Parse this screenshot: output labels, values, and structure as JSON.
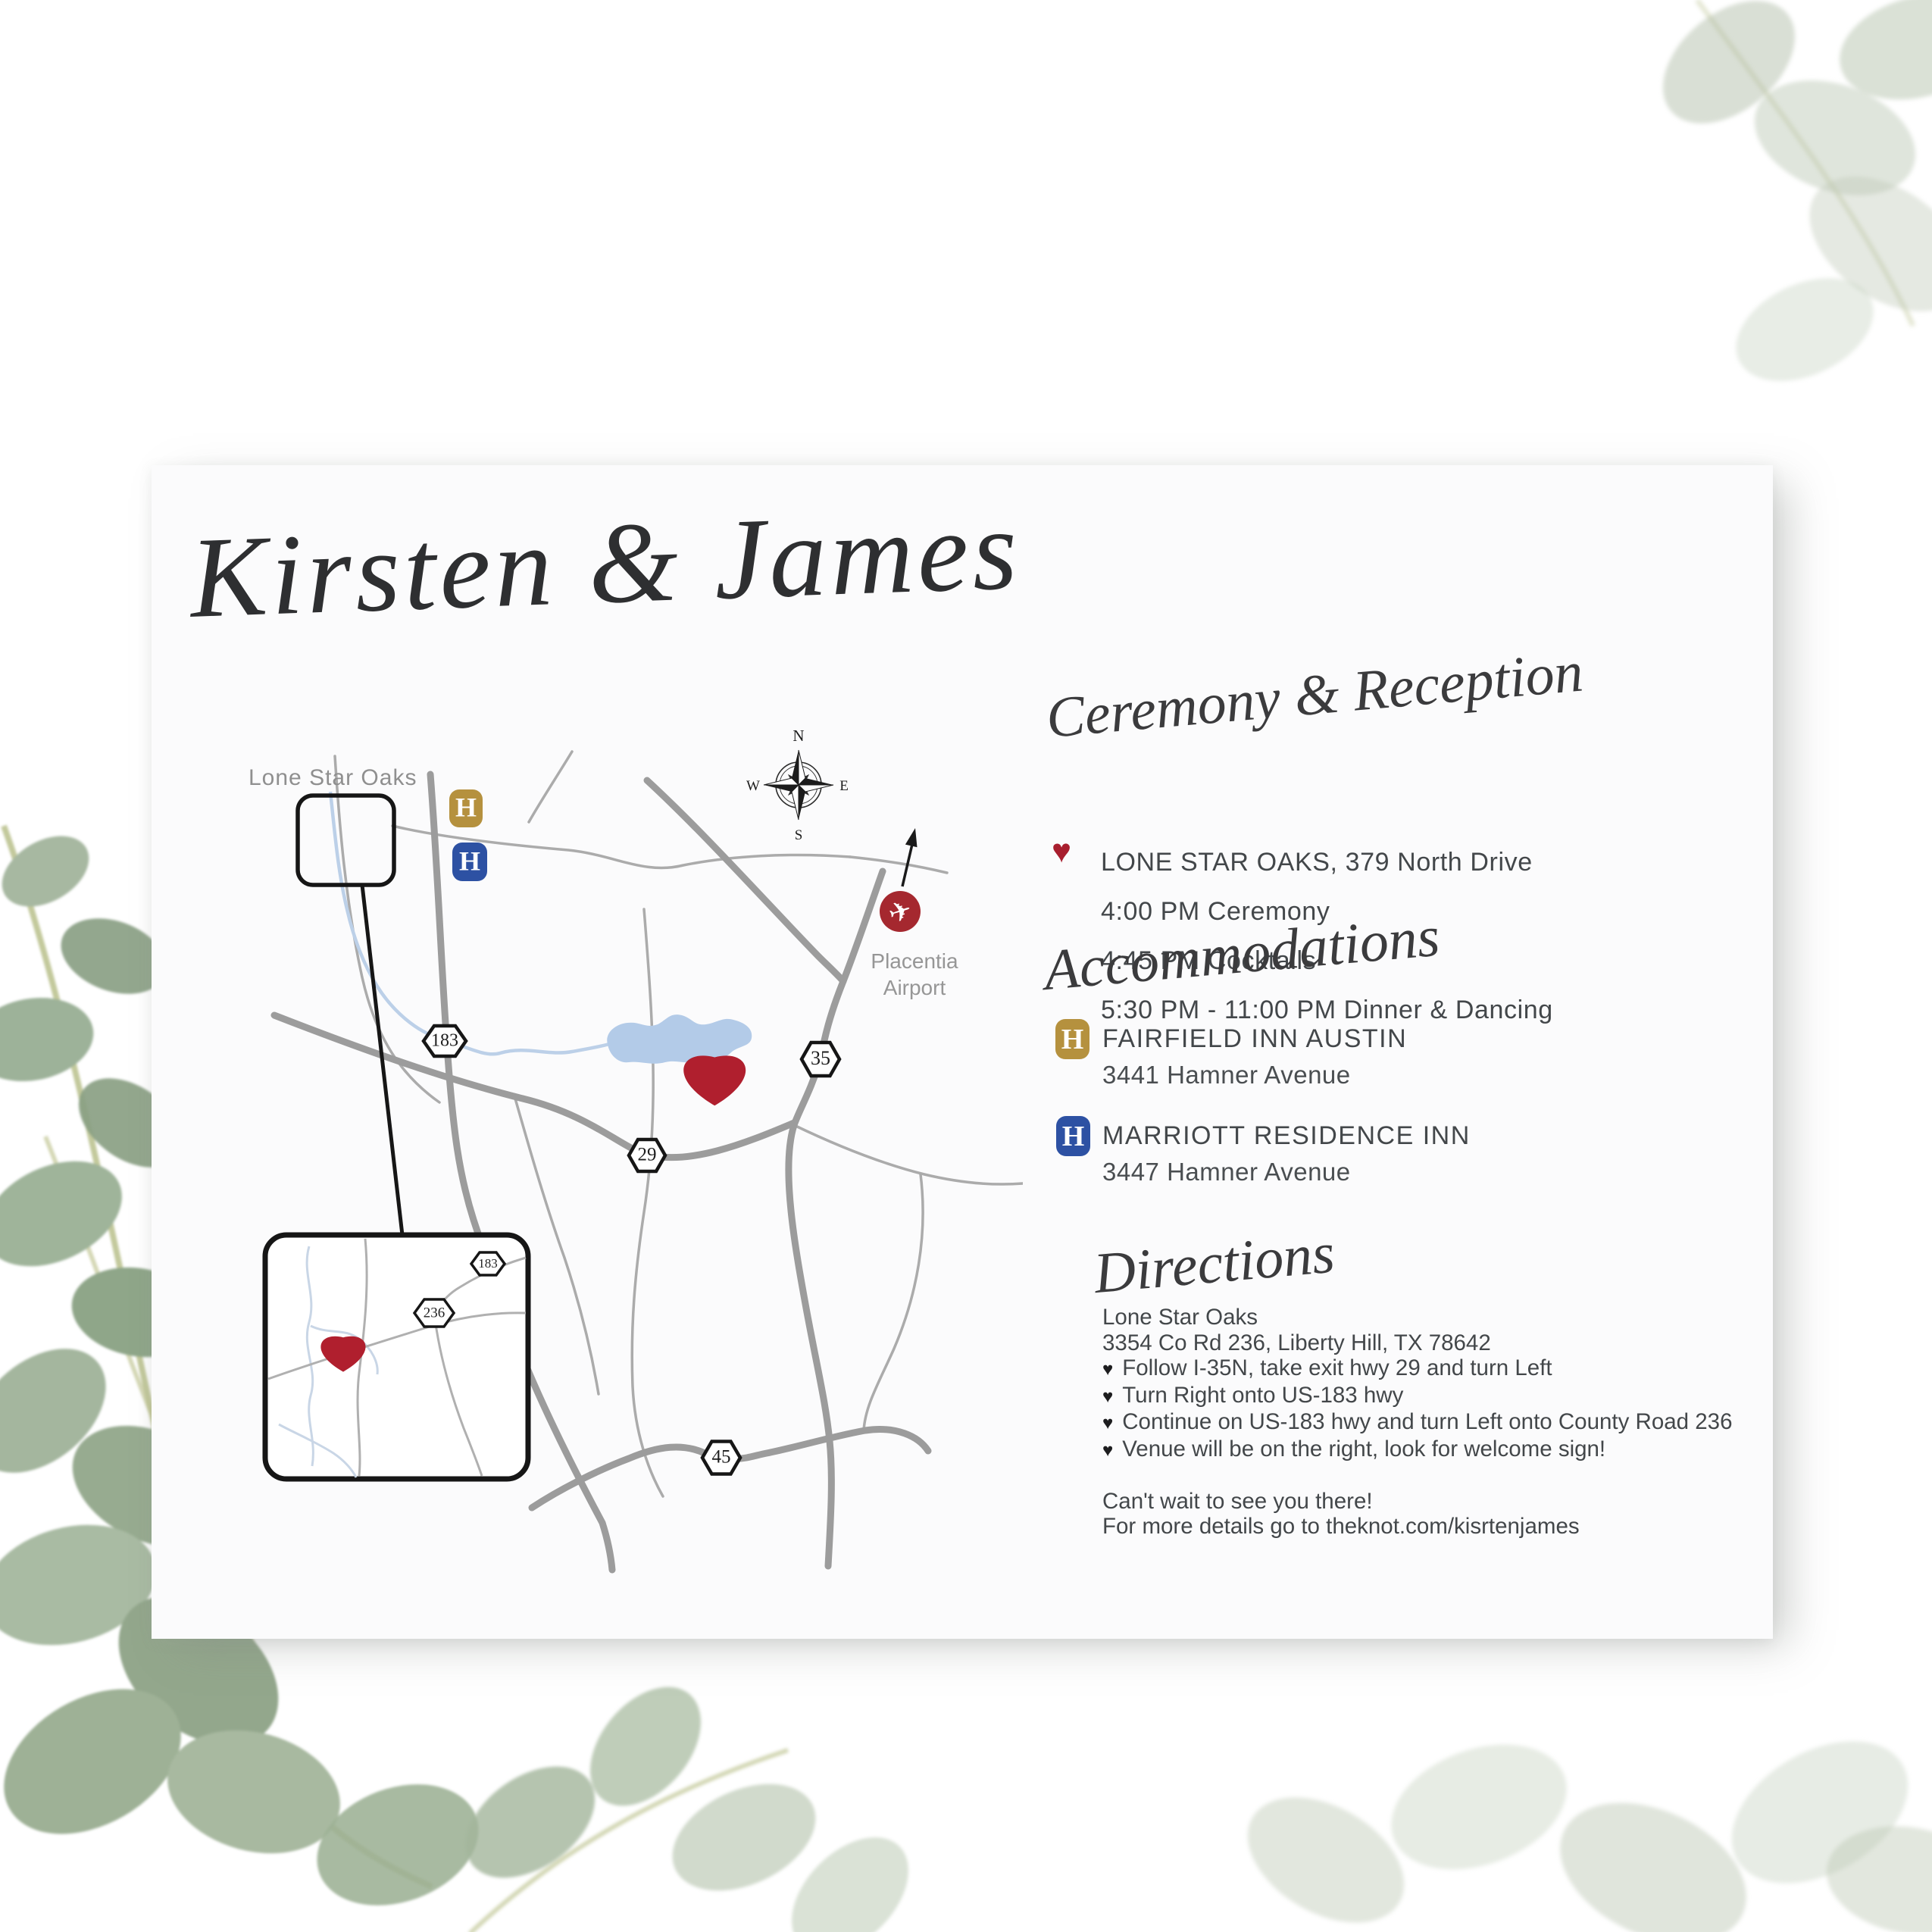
{
  "card": {
    "title": "Kirsten & James",
    "sections": {
      "ceremony": {
        "heading": "Ceremony & Reception",
        "venue_line": "LONE STAR OAKS, 379 North Drive",
        "schedule": [
          "4:00 PM Ceremony",
          "4:45 PM Cocktails",
          "5:30 PM - 11:00 PM Dinner & Dancing"
        ]
      },
      "accommodations": {
        "heading": "Accommodations",
        "hotels": [
          {
            "marker": "H",
            "marker_color": "#b5913e",
            "name": "FAIRFIELD INN AUSTIN",
            "address": "3441 Hamner Avenue"
          },
          {
            "marker": "H",
            "marker_color": "#2d51a3",
            "name": "MARRIOTT RESIDENCE INN",
            "address": "3447 Hamner Avenue"
          }
        ]
      },
      "directions": {
        "heading": "Directions",
        "venue_name": "Lone Star Oaks",
        "venue_address": "3354 Co Rd 236, Liberty Hill, TX 78642",
        "steps": [
          "Follow I-35N, take exit hwy 29 and turn Left",
          "Turn Right onto US-183 hwy",
          "Continue on US-183 hwy and turn Left onto County Road 236",
          "Venue will be on the right, look for welcome sign!"
        ],
        "closing": "Can't wait to see you there!",
        "details": "For more details go to theknot.com/kisrtenjames"
      }
    },
    "map": {
      "venue_label": "Lone Star Oaks",
      "airport_line1": "Placentia",
      "airport_line2": "Airport",
      "compass": {
        "n": "N",
        "e": "E",
        "s": "S",
        "w": "W"
      },
      "shields": {
        "s183": "183",
        "s35": "35",
        "s29": "29",
        "s45": "45",
        "i183": "183",
        "i236": "236"
      },
      "hotel_markers": [
        {
          "label": "H"
        },
        {
          "label": "H"
        }
      ]
    }
  },
  "icons": {
    "heart": "♥",
    "plane": "✈"
  },
  "colors": {
    "accent_red": "#b01f2e",
    "airport_red": "#a5282f",
    "gold": "#b5913e",
    "blue": "#2d51a3",
    "road_gray": "#9c9c9c",
    "thin_road_gray": "#ababab",
    "river_blue": "#bcd0e8",
    "lake_blue": "#b3cbe8",
    "label_gray": "#8f8f8f",
    "text_dark": "#43474a",
    "sage_green": "#9db299"
  }
}
